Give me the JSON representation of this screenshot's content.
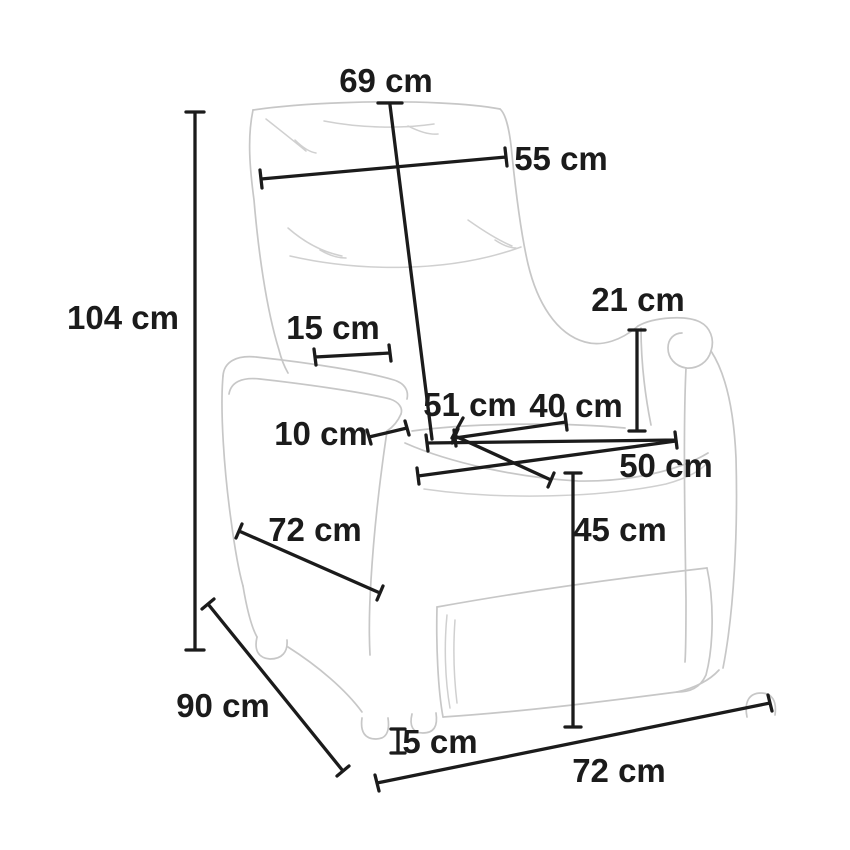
{
  "diagram": {
    "subject": "recliner-armchair-outline-drawing",
    "unit": "cm",
    "background_color": "#ffffff",
    "dimension_line_color": "#1b1b1b",
    "chair_outline_color": "#c7c7c7",
    "label_color": "#1b1b1b"
  },
  "dimensions": [
    {
      "id": "backrest-height",
      "label": "69 cm",
      "value": 69
    },
    {
      "id": "backrest-width",
      "label": "55 cm",
      "value": 55
    },
    {
      "id": "total-height",
      "label": "104 cm",
      "value": 104
    },
    {
      "id": "armrest-top-width",
      "label": "15 cm",
      "value": 15
    },
    {
      "id": "armrest-height-above-seat",
      "label": "21 cm",
      "value": 21
    },
    {
      "id": "armrest-thickness",
      "label": "10 cm",
      "value": 10
    },
    {
      "id": "seat-depth",
      "label": "51 cm",
      "value": 51
    },
    {
      "id": "seat-width-back",
      "label": "40 cm",
      "value": 40
    },
    {
      "id": "seat-width-front",
      "label": "50 cm",
      "value": 50
    },
    {
      "id": "seat-height",
      "label": "45 cm",
      "value": 45
    },
    {
      "id": "side-base-depth",
      "label": "72 cm",
      "value": 72
    },
    {
      "id": "total-depth",
      "label": "90 cm",
      "value": 90
    },
    {
      "id": "foot-height",
      "label": "5 cm",
      "value": 5
    },
    {
      "id": "base-front-width",
      "label": "72 cm",
      "value": 72
    }
  ]
}
